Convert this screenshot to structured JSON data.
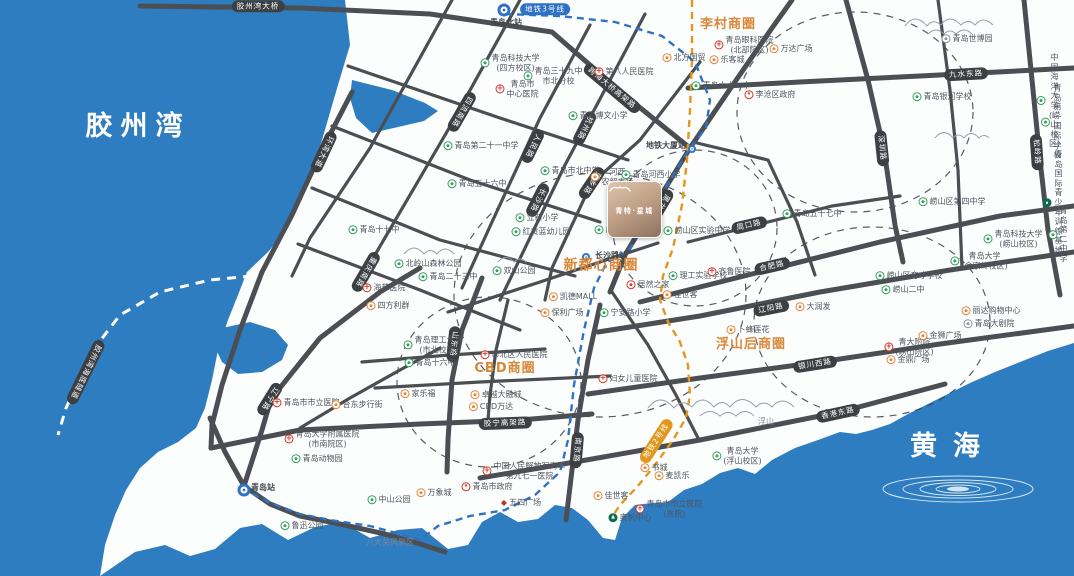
{
  "site": {
    "name": "青特·星城"
  },
  "map": {
    "sea_color": "#2e7dc1",
    "land_color": "#fcfdfd",
    "road_color": "#4b4e52",
    "accent_orange": "#d9883a",
    "metro3_color": "#2f72c4",
    "metro2_color": "#e2981f",
    "labels": [
      {
        "t": "胶州湾",
        "x": 138,
        "y": 127,
        "k": "sea",
        "ls": 8
      },
      {
        "t": "黄海",
        "x": 953,
        "y": 447,
        "k": "sea",
        "ls": 16
      },
      {
        "t": "八大关风景区",
        "x": 390,
        "y": 543,
        "k": "plain"
      },
      {
        "t": "浮山",
        "x": 766,
        "y": 422,
        "k": "plain"
      },
      {
        "t": "李村商圈",
        "x": 728,
        "y": 25,
        "k": "district"
      },
      {
        "t": "新都心商圈",
        "x": 601,
        "y": 266,
        "k": "district",
        "fs": 14
      },
      {
        "t": "CBD商圈",
        "x": 505,
        "y": 369,
        "k": "district"
      },
      {
        "t": "浮山后商圈",
        "x": 751,
        "y": 345,
        "k": "district"
      },
      {
        "t": "胶州湾大桥",
        "x": 258,
        "y": 6,
        "k": "road"
      },
      {
        "t": "胶州湾海底隧道",
        "x": 86,
        "y": 372,
        "k": "road",
        "r": 116
      },
      {
        "t": "环湾大道",
        "x": 324,
        "y": 152,
        "k": "road",
        "r": 115
      },
      {
        "t": "四流南路",
        "x": 462,
        "y": 112,
        "k": "road",
        "r": 120
      },
      {
        "t": "重庆南路",
        "x": 366,
        "y": 272,
        "k": "road",
        "r": 120
      },
      {
        "t": "人民路",
        "x": 533,
        "y": 146,
        "k": "road",
        "r": 116
      },
      {
        "t": "杭州路",
        "x": 585,
        "y": 128,
        "k": "road",
        "r": 117
      },
      {
        "t": "萍乡路",
        "x": 592,
        "y": 183,
        "k": "road",
        "r": 124
      },
      {
        "t": "长沙路",
        "x": 538,
        "y": 200,
        "k": "road",
        "r": 117
      },
      {
        "t": "黑龙江南路",
        "x": 657,
        "y": 213,
        "k": "road",
        "r": 121
      },
      {
        "t": "跨海大桥高架路",
        "x": 612,
        "y": 88,
        "k": "road",
        "r": 40
      },
      {
        "t": "山东路",
        "x": 454,
        "y": 344,
        "k": "road",
        "r": 96
      },
      {
        "t": "南京路",
        "x": 577,
        "y": 450,
        "k": "road",
        "r": 95
      },
      {
        "t": "辽宁路",
        "x": 270,
        "y": 399,
        "k": "road",
        "r": 122
      },
      {
        "t": "胶宁高架路",
        "x": 505,
        "y": 423,
        "k": "road",
        "r": -2
      },
      {
        "t": "九水东路",
        "x": 966,
        "y": 74,
        "k": "road",
        "r": -3
      },
      {
        "t": "深圳路",
        "x": 882,
        "y": 148,
        "k": "road",
        "r": 84
      },
      {
        "t": "松岭路",
        "x": 1037,
        "y": 152,
        "k": "road",
        "r": 86
      },
      {
        "t": "周口路",
        "x": 749,
        "y": 225,
        "k": "road",
        "r": -13
      },
      {
        "t": "合肥路",
        "x": 772,
        "y": 266,
        "k": "road",
        "r": -13
      },
      {
        "t": "辽阳路",
        "x": 771,
        "y": 308,
        "k": "road",
        "r": -11
      },
      {
        "t": "银川西路",
        "x": 815,
        "y": 364,
        "k": "road",
        "r": -9
      },
      {
        "t": "香港东路",
        "x": 838,
        "y": 413,
        "k": "road",
        "r": -12
      },
      {
        "t": "地铁3号线",
        "x": 545,
        "y": 9,
        "k": "m3"
      },
      {
        "t": "地铁2号线",
        "x": 656,
        "y": 441,
        "k": "m2",
        "r": -57
      },
      {
        "t": "青岛北站",
        "x": 506,
        "y": 23,
        "k": "station"
      },
      {
        "t": "地铁大厦站",
        "x": 666,
        "y": 146,
        "k": "station"
      },
      {
        "t": "长沙路站",
        "x": 611,
        "y": 256,
        "k": "station"
      },
      {
        "t": "青岛站",
        "x": 263,
        "y": 488,
        "k": "station"
      },
      {
        "t": "",
        "x": 504,
        "y": 10,
        "k": "stnicon"
      },
      {
        "t": "",
        "x": 692,
        "y": 149,
        "k": "stnicon2"
      },
      {
        "t": "",
        "x": 586,
        "y": 257,
        "k": "stnicon2"
      },
      {
        "t": "",
        "x": 244,
        "y": 490,
        "k": "stnicon"
      },
      {
        "t": "青岛科技大学\n(四方校区)",
        "x": 510,
        "y": 63,
        "k": "school"
      },
      {
        "t": "青岛三十九中\n市北分校",
        "x": 553,
        "y": 76,
        "k": "school"
      },
      {
        "t": "第八人民医院",
        "x": 624,
        "y": 72,
        "k": "hospital"
      },
      {
        "t": "青岛市\n中心医院",
        "x": 517,
        "y": 89,
        "k": "hospital"
      },
      {
        "t": "青岛博文小学",
        "x": 598,
        "y": 116,
        "k": "school"
      },
      {
        "t": "青岛第二十一中学",
        "x": 481,
        "y": 146,
        "k": "school"
      },
      {
        "t": "青岛十七中",
        "x": 374,
        "y": 230,
        "k": "school"
      },
      {
        "t": "青岛五十六中",
        "x": 477,
        "y": 184,
        "k": "school"
      },
      {
        "t": "青岛市北中学",
        "x": 570,
        "y": 171,
        "k": "school"
      },
      {
        "t": "立新小学",
        "x": 537,
        "y": 218,
        "k": "school"
      },
      {
        "t": "红黄蓝幼儿园",
        "x": 541,
        "y": 232,
        "k": "school"
      },
      {
        "t": "北岭山森林公园",
        "x": 428,
        "y": 264,
        "k": "park"
      },
      {
        "t": "青岛二十三中",
        "x": 448,
        "y": 277,
        "k": "school"
      },
      {
        "t": "双山公园",
        "x": 514,
        "y": 271,
        "k": "park"
      },
      {
        "t": "海慈医院",
        "x": 384,
        "y": 288,
        "k": "hospital"
      },
      {
        "t": "四方利群",
        "x": 388,
        "y": 306,
        "k": "shopping"
      },
      {
        "t": "河西\n农贸市场",
        "x": 612,
        "y": 177,
        "k": "shopping"
      },
      {
        "t": "青岛河西小学",
        "x": 651,
        "y": 175,
        "k": "school"
      },
      {
        "t": "启元学校",
        "x": 616,
        "y": 230,
        "k": "school"
      },
      {
        "t": "北方国贸",
        "x": 684,
        "y": 58,
        "k": "shopping"
      },
      {
        "t": "青岛眼科医院\n(北部院区)",
        "x": 744,
        "y": 45,
        "k": "hospital"
      },
      {
        "t": "万达广场",
        "x": 791,
        "y": 49,
        "k": "shopping"
      },
      {
        "t": "乐客城",
        "x": 727,
        "y": 60,
        "k": "shopping"
      },
      {
        "t": "青岛六十一中",
        "x": 721,
        "y": 86,
        "k": "school"
      },
      {
        "t": "李沧区政府",
        "x": 770,
        "y": 95,
        "k": "govt"
      },
      {
        "t": "青岛世博园",
        "x": 967,
        "y": 39,
        "k": "gray"
      },
      {
        "t": "青岛银河学校",
        "x": 942,
        "y": 97,
        "k": "school"
      },
      {
        "t": "中国海洋大学\n(崂山校区)",
        "x": 1049,
        "y": 101,
        "k": "school"
      },
      {
        "t": "青岛第一国际学校",
        "x": 1052,
        "y": 122,
        "k": "school"
      },
      {
        "t": "崂山区第四中学",
        "x": 952,
        "y": 202,
        "k": "school"
      },
      {
        "t": "青岛国际\n青少年训练基地",
        "x": 1053,
        "y": 203,
        "k": "dgreen"
      },
      {
        "t": "青岛科技大学\n(崂山校区)",
        "x": 1013,
        "y": 239,
        "k": "school"
      },
      {
        "t": "青岛第二中学",
        "x": 1058,
        "y": 235,
        "k": "school"
      },
      {
        "t": "青岛大学\n(金家岭校区)",
        "x": 979,
        "y": 261,
        "k": "school"
      },
      {
        "t": "崂山区育才学校",
        "x": 909,
        "y": 276,
        "k": "school"
      },
      {
        "t": "崂山二中",
        "x": 903,
        "y": 290,
        "k": "school"
      },
      {
        "t": "丽达购物中心",
        "x": 991,
        "y": 311,
        "k": "shopping"
      },
      {
        "t": "青岛大剧院",
        "x": 989,
        "y": 324,
        "k": "gray"
      },
      {
        "t": "青大附院\n(崂山院区)",
        "x": 909,
        "y": 347,
        "k": "hospital"
      },
      {
        "t": "金狮广场",
        "x": 940,
        "y": 336,
        "k": "shopping"
      },
      {
        "t": "金鼎广场",
        "x": 908,
        "y": 360,
        "k": "shopping"
      },
      {
        "t": "青岛五十七中",
        "x": 812,
        "y": 214,
        "k": "school"
      },
      {
        "t": "崂山区实验中学",
        "x": 697,
        "y": 231,
        "k": "school"
      },
      {
        "t": "理工实验学校",
        "x": 698,
        "y": 276,
        "k": "school"
      },
      {
        "t": "齐鲁医院",
        "x": 729,
        "y": 272,
        "k": "hospital"
      },
      {
        "t": "居然之家",
        "x": 648,
        "y": 285,
        "k": "shopred"
      },
      {
        "t": "佳世客",
        "x": 680,
        "y": 295,
        "k": "shopping"
      },
      {
        "t": "凯德MALL",
        "x": 573,
        "y": 297,
        "k": "shopping"
      },
      {
        "t": "保利广场",
        "x": 562,
        "y": 313,
        "k": "shopping"
      },
      {
        "t": "宁安路小学",
        "x": 625,
        "y": 313,
        "k": "school"
      },
      {
        "t": "卜蜂莲花",
        "x": 748,
        "y": 330,
        "k": "shopping"
      },
      {
        "t": "大润发",
        "x": 813,
        "y": 307,
        "k": "shopping"
      },
      {
        "t": "妇女儿童医院",
        "x": 628,
        "y": 379,
        "k": "hospital"
      },
      {
        "t": "市北区人民医院",
        "x": 514,
        "y": 355,
        "k": "hospital"
      },
      {
        "t": "青岛理工大学\n(市北校区)",
        "x": 433,
        "y": 345,
        "k": "school"
      },
      {
        "t": "青岛十六中",
        "x": 430,
        "y": 363,
        "k": "school"
      },
      {
        "t": "家乐福",
        "x": 418,
        "y": 394,
        "k": "shopping"
      },
      {
        "t": "卓越大融城",
        "x": 496,
        "y": 395,
        "k": "shopping"
      },
      {
        "t": "CBD万达",
        "x": 491,
        "y": 407,
        "k": "shopping"
      },
      {
        "t": "青岛市市立医院",
        "x": 306,
        "y": 403,
        "k": "hospital"
      },
      {
        "t": "台东步行街",
        "x": 357,
        "y": 405,
        "k": "shopping"
      },
      {
        "t": "青岛大学附属医院\n(市南院区)",
        "x": 322,
        "y": 439,
        "k": "hospital"
      },
      {
        "t": "青岛动物园",
        "x": 317,
        "y": 459,
        "k": "park"
      },
      {
        "t": "中山公园",
        "x": 389,
        "y": 500,
        "k": "park"
      },
      {
        "t": "鲁迅公园",
        "x": 302,
        "y": 526,
        "k": "park"
      },
      {
        "t": "万象城",
        "x": 434,
        "y": 493,
        "k": "shopping"
      },
      {
        "t": "青岛市政府",
        "x": 487,
        "y": 487,
        "k": "govt"
      },
      {
        "t": "中国人民解放军海军\n第九七一医院",
        "x": 524,
        "y": 471,
        "k": "hospital"
      },
      {
        "t": "五四广场",
        "x": 521,
        "y": 503,
        "k": "landmark"
      },
      {
        "t": "书城",
        "x": 654,
        "y": 468,
        "k": "shopping"
      },
      {
        "t": "麦凯乐",
        "x": 672,
        "y": 476,
        "k": "shopping"
      },
      {
        "t": "佳世客",
        "x": 611,
        "y": 496,
        "k": "shopping"
      },
      {
        "t": "青岛市市立医院\n(东院)",
        "x": 669,
        "y": 509,
        "k": "hospital"
      },
      {
        "t": "奥帆中心",
        "x": 630,
        "y": 518,
        "k": "sail"
      },
      {
        "t": "青岛大学\n(浮山校区)",
        "x": 737,
        "y": 456,
        "k": "school"
      }
    ]
  }
}
